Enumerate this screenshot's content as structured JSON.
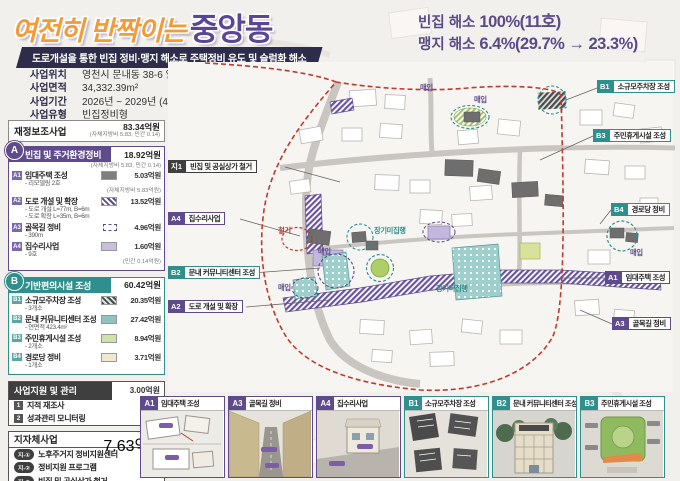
{
  "header": {
    "title_light": "여전히 반짝이는",
    "title_accent": "중앙동",
    "subtitle": "도로개설을 통한 빈집 정비·맹지 해소로 주택정비 유도 및 슬럼화 해소",
    "info": [
      {
        "label": "사업위치",
        "value": "영천시 문내동 38-6 일원"
      },
      {
        "label": "사업면적",
        "value": "34,332.39m²"
      },
      {
        "label": "사업기간",
        "value": "2026년 ~ 2029년 (4년)"
      },
      {
        "label": "사업유형",
        "value": "빈집정비형"
      }
    ],
    "budget": {
      "label": "사 업 비",
      "total": "총사업비 : 96.94억원",
      "lines": [
        "- 재정보조사업 : 83.34억원",
        "- 자체지방비 : 13.40억원",
        "- 민간 : 0.14억원"
      ]
    },
    "stats": [
      {
        "label": "빈집 해소 ",
        "value": "100%(11호)"
      },
      {
        "label": "맹지 해소 ",
        "value": "6.4%(29.7% → 23.3%)"
      }
    ]
  },
  "sidebar": {
    "subsidy": {
      "label": "재정보조사업",
      "value": "83.34억원",
      "note": "(자체지방비 5.83, 민간 0.14)"
    },
    "section_a": {
      "badge": "A",
      "title": "빈집 및 주거환경정비",
      "value": "18.92억원",
      "note": "(자체지방비 5.83, 민간 0.14)",
      "items": [
        {
          "badge": "A1",
          "label": "임대주택 조성",
          "value": "5.03억원",
          "sub1": "- 리모델링 2호",
          "sub2": "",
          "note": "(자체지방비 5.83억원)"
        },
        {
          "badge": "A2",
          "label": "도로 개설 및 확장",
          "value": "13.52억원",
          "sub1": "- 도로 개설 L=77m, B=6m",
          "sub2": "- 도로 확장 L=35m, B=6m",
          "note": ""
        },
        {
          "badge": "A3",
          "label": "골목길 정비",
          "value": "4.96억원",
          "sub1": "- 390m",
          "sub2": "",
          "note": ""
        },
        {
          "badge": "A4",
          "label": "집수리사업",
          "value": "1.60억원",
          "sub1": "- 9호",
          "sub2": "",
          "note": "(민간 0.14억원)"
        }
      ]
    },
    "section_b": {
      "badge": "B",
      "title": "기반편의시설 조성",
      "value": "60.42억원",
      "items": [
        {
          "badge": "B1",
          "label": "소규모주차장 조성",
          "value": "20.35억원",
          "sub1": "- 3개소"
        },
        {
          "badge": "B2",
          "label": "문내 커뮤니티센터 조성",
          "value": "27.42억원",
          "sub1": "- 연면적 423.4m²"
        },
        {
          "badge": "B3",
          "label": "주민휴게시설 조성",
          "value": "8.94억원",
          "sub1": "- 2개소"
        },
        {
          "badge": "B4",
          "label": "경로당 정비",
          "value": "3.71억원",
          "sub1": "- 1개소"
        }
      ]
    },
    "support": {
      "title": "사업지원 및 관리",
      "value": "3.00억원",
      "items": [
        {
          "badge": "1",
          "label": "지적 재조사"
        },
        {
          "badge": "2",
          "label": "성과관리 모니터링"
        }
      ]
    },
    "municipal": {
      "title": "지자체사업",
      "value": "7.63억원",
      "items": [
        {
          "badge": "지-①",
          "label": "노후주거지 정비지원센터"
        },
        {
          "badge": "지-②",
          "label": "정비지원 프로그램"
        },
        {
          "badge": "지-③",
          "label": "빈집 및 공실상가 철거"
        }
      ]
    }
  },
  "map": {
    "callouts": [
      {
        "badge": "지1",
        "label": "빈집 및 공실상가 철거"
      },
      {
        "badge": "A4",
        "label": "집수리사업"
      },
      {
        "badge": "B2",
        "label": "문내 커뮤니티센터 조성"
      },
      {
        "badge": "A2",
        "label": "도로 개설 및 확장"
      },
      {
        "badge": "B1",
        "label": "소규모주차장 조성"
      },
      {
        "badge": "B3",
        "label": "주민휴게시설 조성"
      },
      {
        "badge": "B4",
        "label": "경로당 정비"
      },
      {
        "badge": "A1",
        "label": "임대주택 조성"
      },
      {
        "badge": "A3",
        "label": "골목길 정비"
      }
    ],
    "labels": {
      "demolish": "철거",
      "purchase": "매입",
      "longterm": "장기미집행"
    }
  },
  "thumbnails": [
    {
      "badge": "A1",
      "label": "임대주택 조성"
    },
    {
      "badge": "A3",
      "label": "골목길 정비"
    },
    {
      "badge": "A4",
      "label": "집수리사업"
    },
    {
      "badge": "B1",
      "label": "소규모주차장 조성"
    },
    {
      "badge": "B2",
      "label": "문내 커뮤니티센터 조성"
    },
    {
      "badge": "B3",
      "label": "주민휴게시설 조성"
    }
  ],
  "colors": {
    "purple": "#5f4b8b",
    "teal": "#2f8f8c",
    "orange": "#f29b38",
    "navy": "#2d2c4a",
    "red": "#c0392b"
  }
}
